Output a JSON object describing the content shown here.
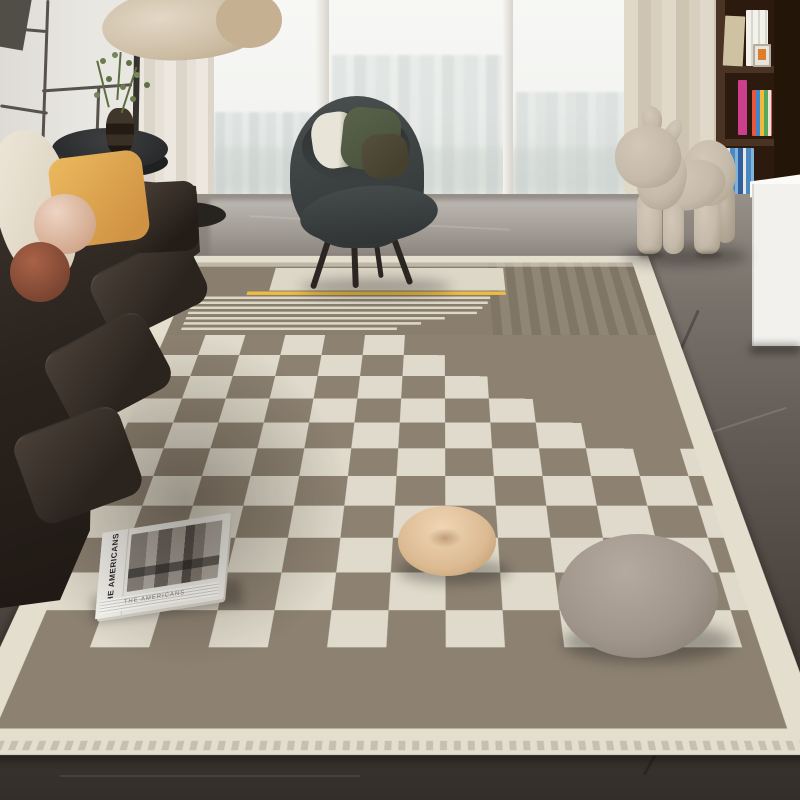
{
  "scene": {
    "description": "Photograph of a modern living room: dark leather sofa with pillows, round black side table with plant, charcoal lounge armchair by a floor-to-ceiling window, beige pony-shaped chair sculpture, dark wood bookshelf, and a large taupe-and-cream checkerboard area rug with stripe accents, a photo book and two round floor cushions on it",
    "book": {
      "title": "THE AMERICANS"
    },
    "objects": [
      "leather sofa",
      "cream pillow",
      "mustard pillow",
      "pink ball pillow",
      "brown ball pillow",
      "crumpled beige pillow",
      "round black side table",
      "vase with green plant",
      "floor lamp",
      "sheer curtain",
      "city window",
      "lounge armchair",
      "cream cushion",
      "green cushion",
      "olive cushion",
      "beige curtain",
      "pony chair sculpture",
      "bookshelf with books",
      "picture frame",
      "white cabinet",
      "checkerboard area rug",
      "yellow accent stripe",
      "photo book",
      "beige round pouf",
      "gray plush cushion",
      "marble floor"
    ]
  },
  "palette": {
    "wall": "#e9e7e2",
    "trim": "#57524c",
    "windowlight": "#f5f6f3",
    "floortop": "#979089",
    "floormid": "#5e5751",
    "floordark": "#453f39",
    "floorbottom": "#332e29",
    "rugcream": "#e4decf",
    "rugcream2": "#dfdacb",
    "rugtaupe": "#8d8272",
    "rugtopfield": "#8a7f6e",
    "rugyellow": "#edbc41",
    "sofadark1": "#2a231d",
    "sofadark2": "#1d1713",
    "pillowcream": "#efe8da",
    "pillowyellow": "#ecb95e",
    "pillowpink": "#eed4c4",
    "pillowbrown": "#a96247",
    "chairshell": "#3b4040",
    "chairdark": "#303435",
    "cushioncream": "#e9e4d8",
    "cushiongreen": "#4c5540",
    "cushionolive": "#46412f",
    "pony1": "#c6bbaa",
    "pony2": "#a99d8b",
    "shelfframe": "#4a3322",
    "shelfback": "#2c1a0e",
    "shelfside": "#241509",
    "cabinet": "#f2f1ee",
    "tableblack": "#2a2b2d",
    "vase": "#41362a",
    "plant": "#5d6e43",
    "poufbeige1": "#efd6b6",
    "poufbeige2": "#bb9568",
    "poufgray1": "#b4aaa0",
    "poufgray2": "#877d72",
    "bookwhite": "#f4f2ec"
  }
}
